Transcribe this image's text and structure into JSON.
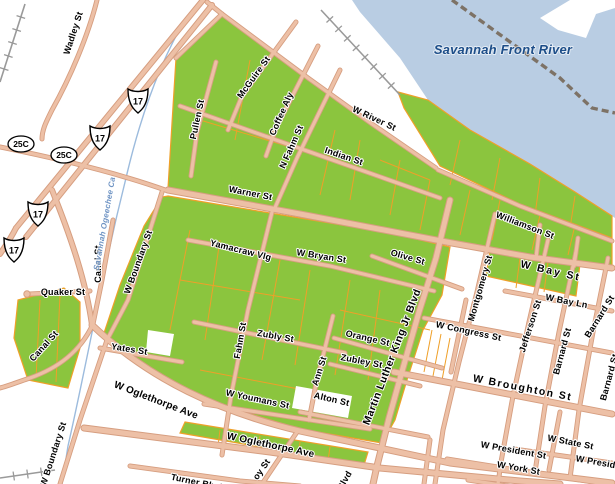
{
  "map": {
    "title": "Savannah street map with highlighted parcels",
    "water": {
      "river_label": {
        "text": "Savannah Front River",
        "x": 503,
        "y": 54,
        "size": 13,
        "color": "#1d4e89"
      },
      "canal_label": {
        "text": "Savannah Ogeechee Ca",
        "x": 107,
        "y": 224,
        "rot": -80,
        "size": 8,
        "color": "#6f94c4"
      }
    },
    "street_labels": [
      {
        "text": "Wadley St",
        "x": 76,
        "y": 34,
        "rot": -72
      },
      {
        "text": "W River St",
        "x": 373,
        "y": 121,
        "rot": 25
      },
      {
        "text": "Indian St",
        "x": 343,
        "y": 159,
        "rot": 19
      },
      {
        "text": "McGuire St",
        "x": 256,
        "y": 79,
        "rot": -54
      },
      {
        "text": "Coffee Aly",
        "x": 284,
        "y": 115,
        "rot": -66
      },
      {
        "text": "N Fahm St",
        "x": 294,
        "y": 148,
        "rot": -66
      },
      {
        "text": "Pullen St",
        "x": 200,
        "y": 120,
        "rot": -78
      },
      {
        "text": "Warner St",
        "x": 250,
        "y": 196,
        "rot": 11
      },
      {
        "text": "Williamson St",
        "x": 524,
        "y": 228,
        "rot": 21
      },
      {
        "text": "W Bay St",
        "x": 550,
        "y": 274,
        "rot": 13,
        "size": 10.5,
        "ls": 2
      },
      {
        "text": "Olive St",
        "x": 407,
        "y": 260,
        "rot": 16
      },
      {
        "text": "Yamacraw Vlg",
        "x": 240,
        "y": 253,
        "rot": 14
      },
      {
        "text": "W Bryan St",
        "x": 321,
        "y": 259,
        "rot": 9
      },
      {
        "text": "Montgomery St",
        "x": 483,
        "y": 289,
        "rot": -74
      },
      {
        "text": "W Bay Ln",
        "x": 566,
        "y": 304,
        "rot": 11
      },
      {
        "text": "Jefferson St",
        "x": 533,
        "y": 327,
        "rot": -72
      },
      {
        "text": "Barnard St",
        "x": 565,
        "y": 352,
        "rot": -75
      },
      {
        "text": "Barnard St",
        "x": 602,
        "y": 318,
        "rot": -58
      },
      {
        "text": "Barnard St",
        "x": 612,
        "y": 378,
        "rot": -75
      },
      {
        "text": "W Congress St",
        "x": 468,
        "y": 334,
        "rot": 12
      },
      {
        "text": "W Broughton St",
        "x": 522,
        "y": 391,
        "rot": 11,
        "size": 10.5,
        "ls": 1.5
      },
      {
        "text": "W State St",
        "x": 570,
        "y": 445,
        "rot": 11
      },
      {
        "text": "W President St",
        "x": 513,
        "y": 453,
        "rot": 10
      },
      {
        "text": "W President St",
        "x": 608,
        "y": 467,
        "rot": 10
      },
      {
        "text": "W York St",
        "x": 518,
        "y": 471,
        "rot": 10
      },
      {
        "text": "Martin Luther King Jr Blvd",
        "x": 395,
        "y": 358,
        "rot": -69,
        "size": 10.5,
        "ls": 0.5
      },
      {
        "text": "Blvd",
        "x": 347,
        "y": 482,
        "rot": -60
      },
      {
        "text": "Orange St",
        "x": 367,
        "y": 341,
        "rot": 13
      },
      {
        "text": "Zubley St",
        "x": 361,
        "y": 364,
        "rot": 11
      },
      {
        "text": "Ann St",
        "x": 322,
        "y": 372,
        "rot": -72
      },
      {
        "text": "Alton St",
        "x": 331,
        "y": 402,
        "rot": 13
      },
      {
        "text": "Zubly St",
        "x": 275,
        "y": 339,
        "rot": 10
      },
      {
        "text": "Fahm St",
        "x": 243,
        "y": 341,
        "rot": -80
      },
      {
        "text": "W Boundary St",
        "x": 141,
        "y": 263,
        "rot": -70
      },
      {
        "text": "W Boundary St",
        "x": 56,
        "y": 455,
        "rot": -72
      },
      {
        "text": "Canal St",
        "x": 101,
        "y": 264,
        "rot": -90
      },
      {
        "text": "Canal St",
        "x": 46,
        "y": 348,
        "rot": -48
      },
      {
        "text": "Quaker St",
        "x": 63,
        "y": 295,
        "rot": 0
      },
      {
        "text": "Yates St",
        "x": 129,
        "y": 352,
        "rot": 9
      },
      {
        "text": "W Youmans St",
        "x": 257,
        "y": 402,
        "rot": 12
      },
      {
        "text": "W Oglethorpe Ave",
        "x": 155,
        "y": 403,
        "rot": 21,
        "size": 10
      },
      {
        "text": "W Oglethorpe Ave",
        "x": 270,
        "y": 448,
        "rot": 12,
        "size": 10
      },
      {
        "text": "oy St",
        "x": 264,
        "y": 471,
        "rot": -55
      },
      {
        "text": "Turner Blvd",
        "x": 196,
        "y": 485,
        "rot": 12
      }
    ],
    "highway_shields": [
      {
        "type": "us-route",
        "number": "17",
        "x": 138,
        "y": 101
      },
      {
        "type": "us-route",
        "number": "17",
        "x": 100,
        "y": 138
      },
      {
        "type": "us-route",
        "number": "17",
        "x": 38,
        "y": 214
      },
      {
        "type": "us-route",
        "number": "17",
        "x": 14,
        "y": 250
      },
      {
        "type": "state-oval",
        "number": "25C",
        "x": 21,
        "y": 144
      },
      {
        "type": "state-oval",
        "number": "25C",
        "x": 64,
        "y": 155
      }
    ],
    "colors": {
      "river": "#b9cde3",
      "land": "#ffffff",
      "parcel_green": "#8bc53e",
      "parcel_outline": "#efa029",
      "road_fill": "#edc0a6",
      "road_casing": "#d69e80",
      "rail": "#9a9a9a",
      "rail_heavy": "#7d7266",
      "canal": "#9cbbdd",
      "label": "#000000",
      "water_label": "#1d4e89"
    }
  }
}
